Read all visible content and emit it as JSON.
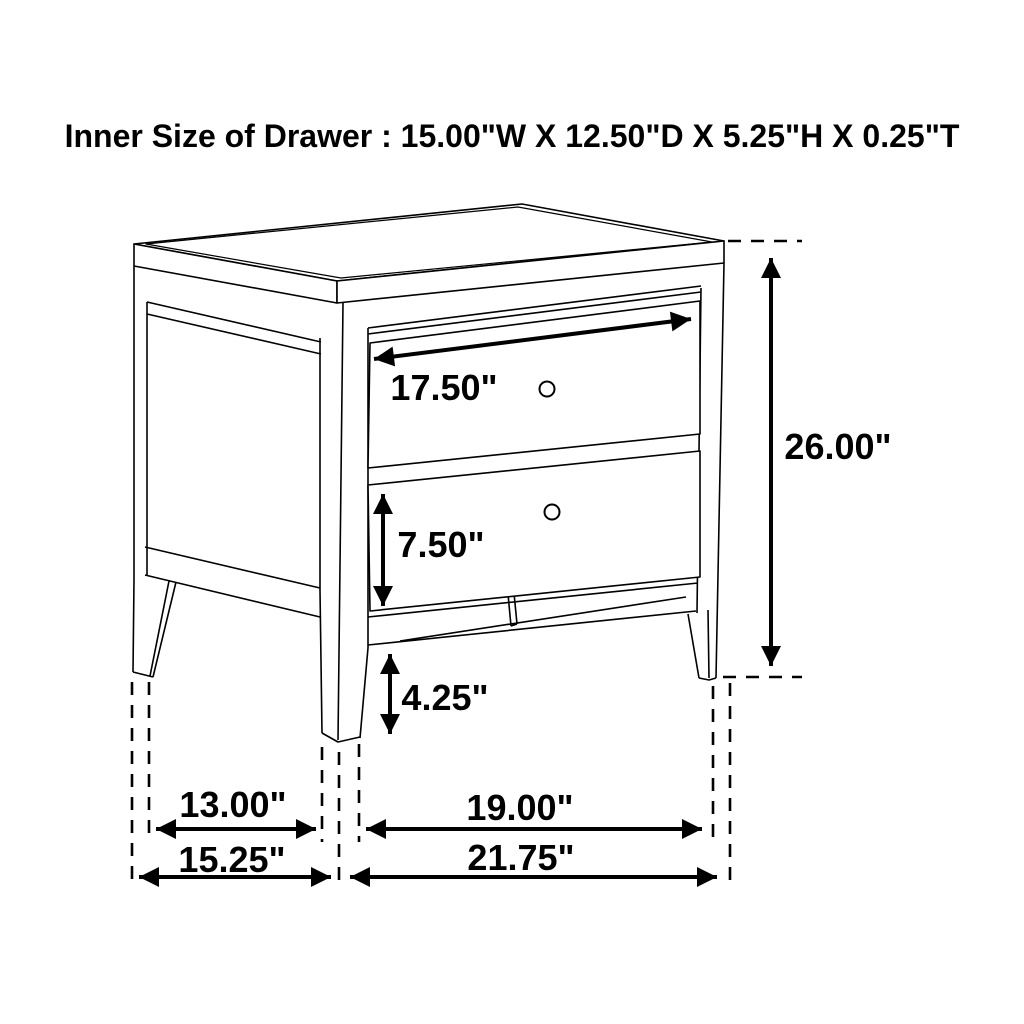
{
  "title": "Inner Size of Drawer : 15.00\"W X 12.50\"D X 5.25\"H X 0.25\"T",
  "inner_drawer_size": {
    "width": "15.00\"W",
    "depth": "12.50\"D",
    "height": "5.25\"H",
    "thickness": "0.25\"T"
  },
  "diagram": {
    "subject": "two-drawer nightstand wireframe line drawing with dimension arrows",
    "knob_count": 2,
    "line_color": "#000000",
    "background_color": "#ffffff",
    "dimensions": [
      {
        "id": "top-drawer-front-width",
        "label": "17.50\"",
        "inches": 17.5
      },
      {
        "id": "bottom-drawer-front-height",
        "label": "7.50\"",
        "inches": 7.5
      },
      {
        "id": "leg-height-below-case",
        "label": "4.25\"",
        "inches": 4.25
      },
      {
        "id": "overall-height",
        "label": "26.00\"",
        "inches": 26.0
      },
      {
        "id": "side-leg-spacing",
        "label": "13.00\"",
        "inches": 13.0
      },
      {
        "id": "front-leg-spacing",
        "label": "19.00\"",
        "inches": 19.0
      },
      {
        "id": "overall-depth",
        "label": "15.25\"",
        "inches": 15.25
      },
      {
        "id": "overall-width",
        "label": "21.75\"",
        "inches": 21.75
      }
    ]
  }
}
